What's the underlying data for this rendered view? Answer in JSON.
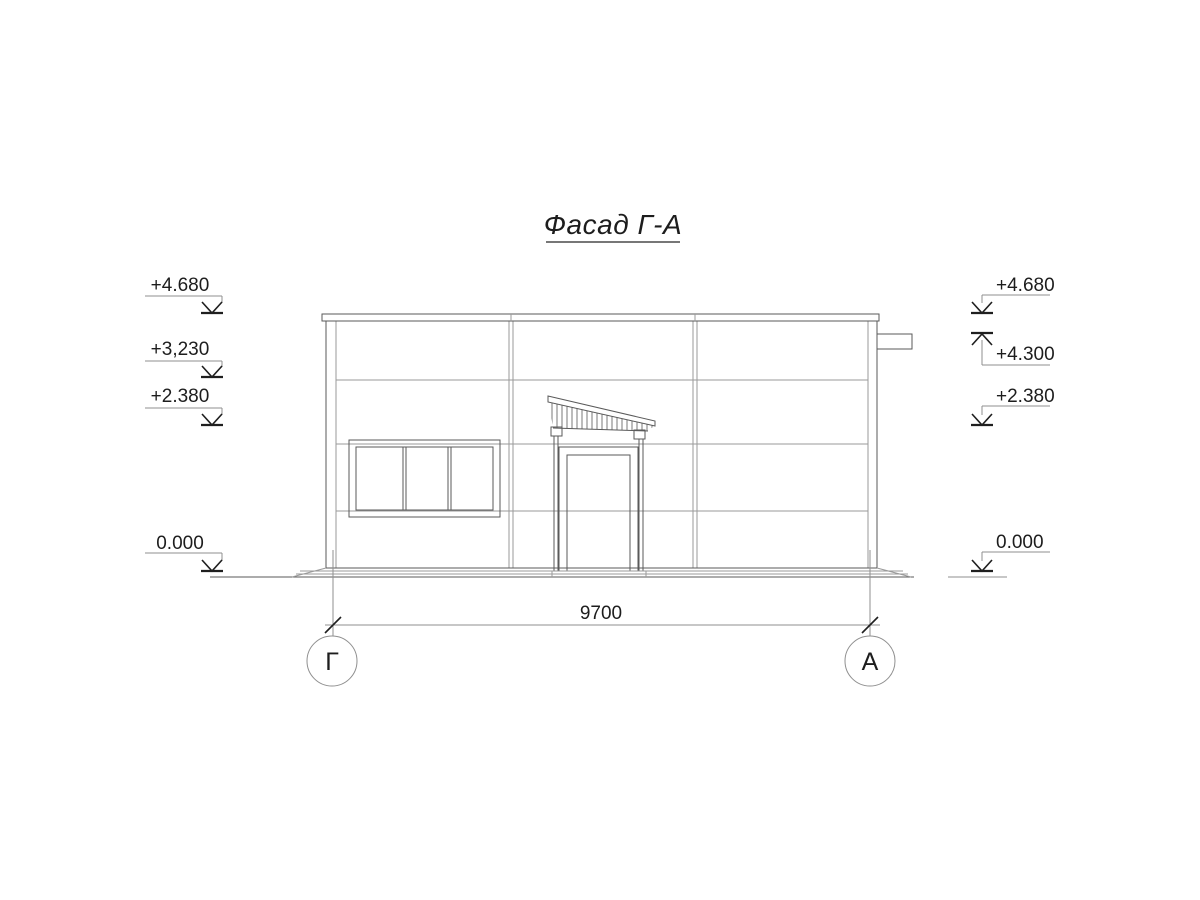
{
  "title": "Фасад Г-А",
  "colors": {
    "background": "#ffffff",
    "outline": "#5a5a5a",
    "thin_line": "#9a9a9a",
    "text": "#1d1d1d"
  },
  "elevations": {
    "left": [
      {
        "label": "+4.680"
      },
      {
        "label": "+3,230"
      },
      {
        "label": "+2.380"
      },
      {
        "label": "0.000"
      }
    ],
    "right": [
      {
        "label": "+4.680"
      },
      {
        "label": "+4.300"
      },
      {
        "label": "+2.380"
      },
      {
        "label": "0.000"
      }
    ]
  },
  "dimension": {
    "value": "9700"
  },
  "axes": [
    {
      "label": "Г"
    },
    {
      "label": "А"
    }
  ]
}
